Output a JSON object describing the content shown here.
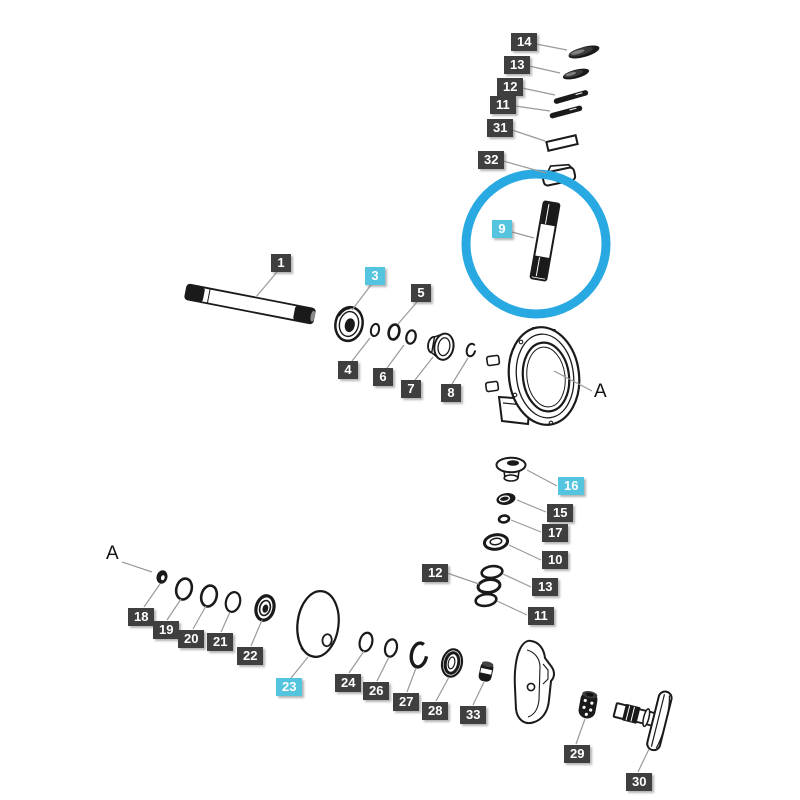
{
  "diagram": {
    "description_text": "",
    "colors": {
      "label_dark": "#3f3f3f",
      "label_cyan": "#55c4df",
      "label_text": "#ffffff",
      "leader_line": "#9a9a9a",
      "highlight": "#29a9e1",
      "line_art": "#1a1a1a",
      "background": "#ffffff"
    },
    "highlight_circle": {
      "cx": 536,
      "cy": 244,
      "r": 70,
      "stroke_width": 9
    },
    "reference_letters": [
      {
        "text": "A",
        "x": 594,
        "y": 382,
        "leader": [
          592,
          391,
          554,
          371
        ]
      },
      {
        "text": "A",
        "x": 106,
        "y": 544,
        "leader": [
          122,
          562,
          152,
          572
        ]
      }
    ],
    "labels": [
      {
        "id": "14-top",
        "text": "14",
        "style": "dark",
        "x": 511,
        "y": 33,
        "leader": [
          536,
          44,
          567,
          50
        ]
      },
      {
        "id": "13-top",
        "text": "13",
        "style": "dark",
        "x": 504,
        "y": 56,
        "leader": [
          529,
          66,
          560,
          73
        ]
      },
      {
        "id": "12-top",
        "text": "12",
        "style": "dark",
        "x": 497,
        "y": 78,
        "leader": [
          522,
          88,
          555,
          95
        ]
      },
      {
        "id": "11-top",
        "text": "11",
        "style": "dark",
        "x": 490,
        "y": 96,
        "leader": [
          515,
          106,
          550,
          111
        ]
      },
      {
        "id": "31",
        "text": "31",
        "style": "dark",
        "x": 487,
        "y": 119,
        "leader": [
          512,
          130,
          545,
          141
        ]
      },
      {
        "id": "32",
        "text": "32",
        "style": "dark",
        "x": 478,
        "y": 151,
        "leader": [
          503,
          161,
          546,
          173
        ]
      },
      {
        "id": "9",
        "text": "9",
        "style": "cyan",
        "x": 492,
        "y": 220,
        "leader": [
          512,
          232,
          534,
          238
        ]
      },
      {
        "id": "1",
        "text": "1",
        "style": "dark",
        "x": 271,
        "y": 254,
        "leader": [
          277,
          272,
          256,
          297
        ]
      },
      {
        "id": "3",
        "text": "3",
        "style": "cyan",
        "x": 365,
        "y": 267,
        "leader": [
          371,
          285,
          352,
          310
        ]
      },
      {
        "id": "5",
        "text": "5",
        "style": "dark",
        "x": 411,
        "y": 284,
        "leader": [
          417,
          302,
          398,
          324
        ]
      },
      {
        "id": "4",
        "text": "4",
        "style": "dark",
        "x": 338,
        "y": 361,
        "leader": [
          352,
          361,
          370,
          338
        ]
      },
      {
        "id": "6",
        "text": "6",
        "style": "dark",
        "x": 373,
        "y": 368,
        "leader": [
          387,
          368,
          404,
          345
        ]
      },
      {
        "id": "7",
        "text": "7",
        "style": "dark",
        "x": 401,
        "y": 380,
        "leader": [
          415,
          380,
          433,
          357
        ]
      },
      {
        "id": "8",
        "text": "8",
        "style": "dark",
        "x": 441,
        "y": 384,
        "leader": [
          452,
          384,
          468,
          358
        ]
      },
      {
        "id": "16",
        "text": "16",
        "style": "cyan",
        "x": 558,
        "y": 477,
        "leader": [
          557,
          486,
          527,
          470
        ]
      },
      {
        "id": "15",
        "text": "15",
        "style": "dark",
        "x": 547,
        "y": 504,
        "leader": [
          546,
          512,
          517,
          500
        ]
      },
      {
        "id": "17",
        "text": "17",
        "style": "dark",
        "x": 542,
        "y": 524,
        "leader": [
          541,
          532,
          511,
          520
        ]
      },
      {
        "id": "10",
        "text": "10",
        "style": "dark",
        "x": 542,
        "y": 551,
        "leader": [
          541,
          560,
          509,
          545
        ]
      },
      {
        "id": "12-lower",
        "text": "12",
        "style": "dark",
        "x": 422,
        "y": 564,
        "leader": [
          447,
          573,
          479,
          584
        ]
      },
      {
        "id": "13-lower",
        "text": "13",
        "style": "dark",
        "x": 532,
        "y": 578,
        "leader": [
          531,
          587,
          503,
          574
        ]
      },
      {
        "id": "11-lower",
        "text": "11",
        "style": "dark",
        "x": 528,
        "y": 607,
        "leader": [
          527,
          615,
          497,
          601
        ]
      },
      {
        "id": "18",
        "text": "18",
        "style": "dark",
        "x": 128,
        "y": 608,
        "leader": [
          144,
          607,
          160,
          584
        ]
      },
      {
        "id": "19",
        "text": "19",
        "style": "dark",
        "x": 153,
        "y": 621,
        "leader": [
          167,
          620,
          181,
          599
        ]
      },
      {
        "id": "20",
        "text": "20",
        "style": "dark",
        "x": 178,
        "y": 630,
        "leader": [
          193,
          629,
          206,
          606
        ]
      },
      {
        "id": "21",
        "text": "21",
        "style": "dark",
        "x": 207,
        "y": 633,
        "leader": [
          221,
          632,
          230,
          612
        ]
      },
      {
        "id": "22",
        "text": "22",
        "style": "dark",
        "x": 237,
        "y": 647,
        "leader": [
          251,
          646,
          262,
          620
        ]
      },
      {
        "id": "23",
        "text": "23",
        "style": "cyan",
        "x": 276,
        "y": 678,
        "leader": [
          291,
          678,
          308,
          657
        ]
      },
      {
        "id": "24",
        "text": "24",
        "style": "dark",
        "x": 335,
        "y": 674,
        "leader": [
          349,
          673,
          364,
          651
        ]
      },
      {
        "id": "26",
        "text": "26",
        "style": "dark",
        "x": 363,
        "y": 682,
        "leader": [
          377,
          681,
          389,
          657
        ]
      },
      {
        "id": "27",
        "text": "27",
        "style": "dark",
        "x": 393,
        "y": 693,
        "leader": [
          407,
          692,
          416,
          668
        ]
      },
      {
        "id": "28",
        "text": "28",
        "style": "dark",
        "x": 422,
        "y": 702,
        "leader": [
          436,
          701,
          449,
          677
        ]
      },
      {
        "id": "33",
        "text": "33",
        "style": "dark",
        "x": 460,
        "y": 706,
        "leader": [
          473,
          705,
          484,
          682
        ]
      },
      {
        "id": "29",
        "text": "29",
        "style": "dark",
        "x": 564,
        "y": 745,
        "leader": [
          576,
          744,
          585,
          719
        ]
      },
      {
        "id": "30",
        "text": "30",
        "style": "dark",
        "x": 626,
        "y": 773,
        "leader": [
          638,
          772,
          649,
          749
        ]
      }
    ]
  }
}
